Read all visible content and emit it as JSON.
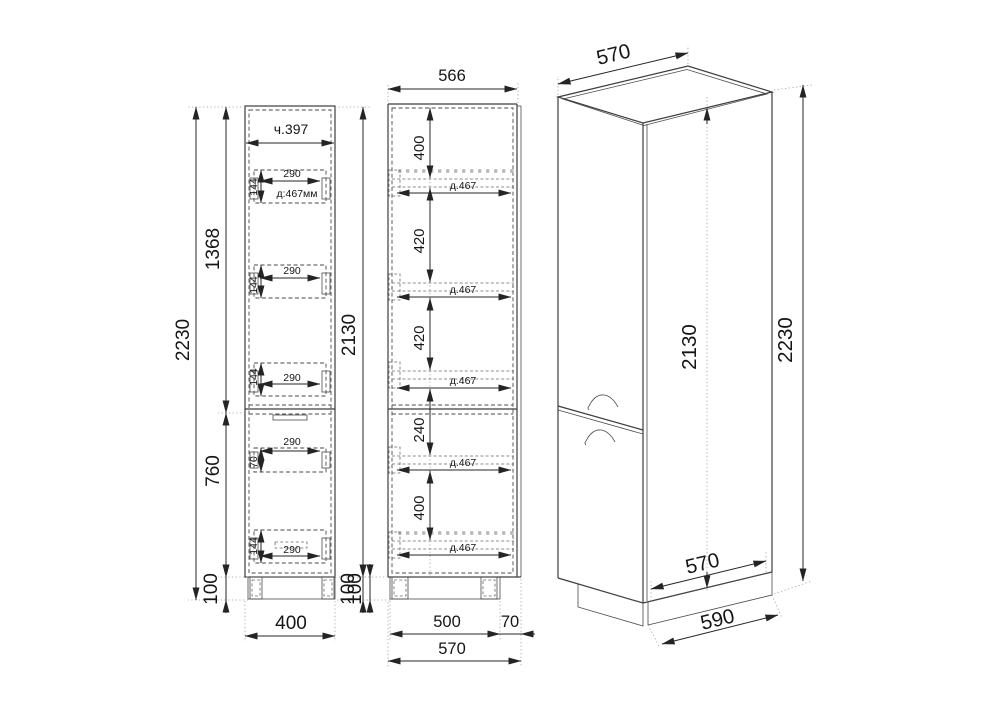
{
  "drawing": {
    "kind": "furniture-technical-drawing",
    "front": {
      "part": "ч.397",
      "total_height": "2230",
      "upper_height": "1368",
      "lower_height": "760",
      "plinth_left": "100",
      "width": "400",
      "carcass_height": "2130",
      "plinth_right": "100",
      "handles": [
        {
          "w": "290",
          "h": "144",
          "note": "д:467мм"
        },
        {
          "w": "290",
          "h": "144"
        },
        {
          "w": "290",
          "h": "144"
        },
        {
          "w": "290",
          "h": "70"
        },
        {
          "w": "290",
          "h": "144"
        }
      ]
    },
    "side": {
      "top_width": "566",
      "gaps": [
        "400",
        "420",
        "420",
        "240",
        "400"
      ],
      "shelf_labels": [
        "д.467",
        "д.467",
        "д.467",
        "д.467",
        "д.467"
      ],
      "plinth": "100",
      "body_depth": "500",
      "door_offset": "70",
      "total_depth": "570"
    },
    "iso": {
      "top_depth": "570",
      "carcass_height": "2130",
      "total_height": "2230",
      "bottom_depth": "570",
      "plinth_depth": "590"
    }
  }
}
